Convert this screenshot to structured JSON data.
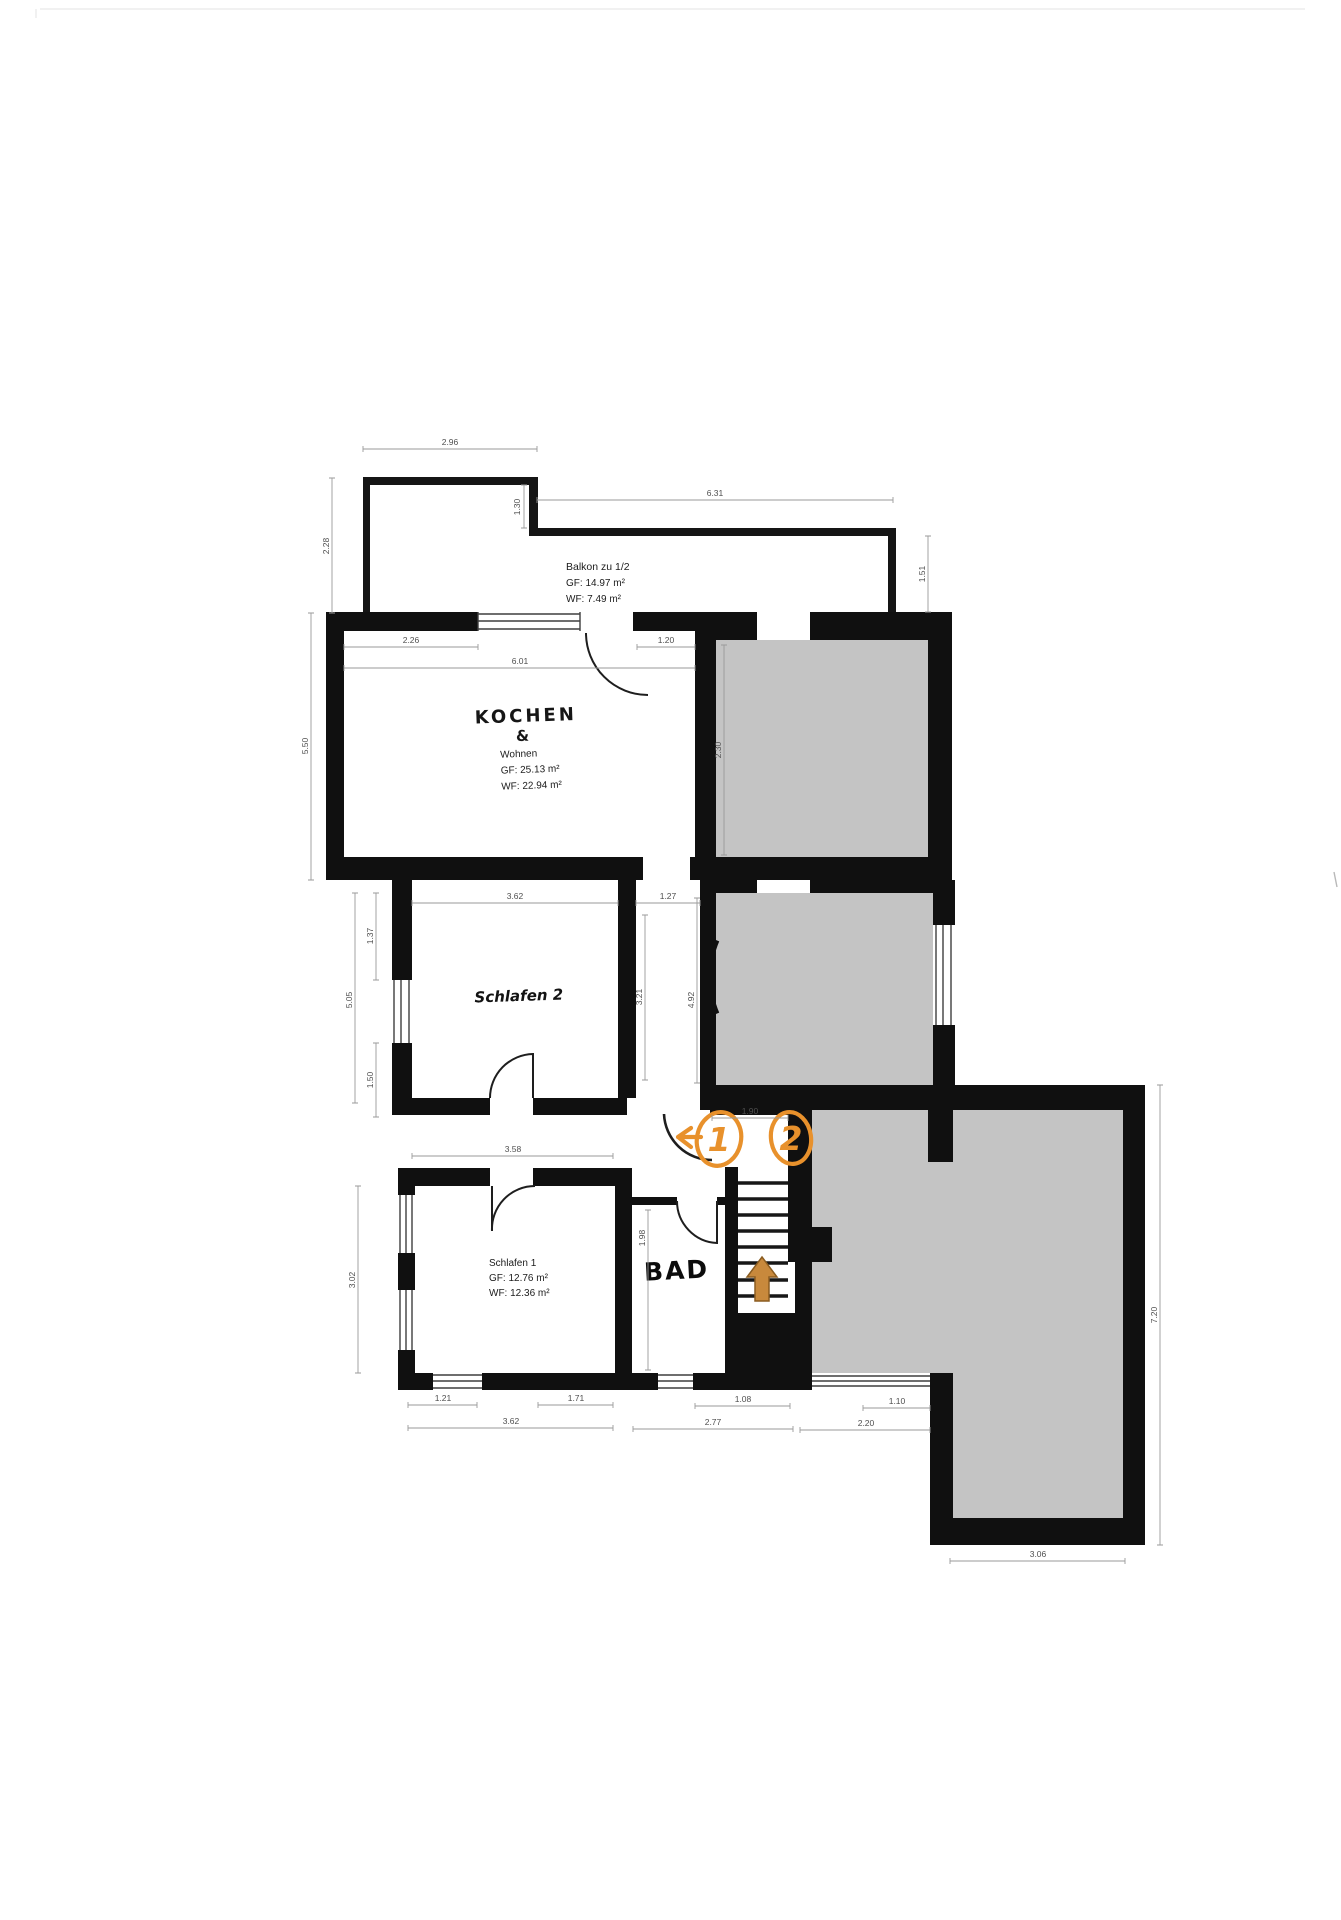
{
  "plan_title": "Obergeschoss Wohnungsplan",
  "colors": {
    "wall": "#101010",
    "neighbor_room_fill": "#c4c4c4",
    "annotation_orange": "#e8912c",
    "stair_arrow_fill": "#c8893c",
    "dim_text": "#4f4f4f"
  },
  "rooms": {
    "balkon": {
      "name": "Balkon zu 1/2",
      "gf": "GF: 14.97 m²",
      "wf": "WF: 7.49 m²"
    },
    "kochen_wohnen": {
      "line1": "KOCHEN",
      "line2": "&",
      "line3": "Wohnen",
      "gf": "GF: 25.13 m²",
      "wf": "WF: 22.94 m²"
    },
    "schlafen2": {
      "name": "Schlafen 2"
    },
    "schlafen1": {
      "name": "Schlafen 1",
      "gf": "GF: 12.76 m²",
      "wf": "WF: 12.36 m²"
    },
    "bad": {
      "name": "BAD"
    }
  },
  "annotations": {
    "route_marker_1": "1",
    "route_marker_2": "2"
  },
  "dims": {
    "balcony_top": "2.96",
    "balcony_span": "6.31",
    "balcony_left": "2.28",
    "balcony_step": "1.30",
    "balcony_right_h": "1.51",
    "kitchen_top": "2.26",
    "kitchen_full": "6.01",
    "kitchen_door": "1.20",
    "kitchen_left": "5.50",
    "gray1_left": "2.30",
    "schlafen2_top": "3.62",
    "corridor_top": "1.27",
    "corridor_len": "3.21",
    "corridor_len2": "4.92",
    "left_upper": "1.37",
    "left_full": "5.05",
    "left_lower": "1.50",
    "flur": "3.58",
    "stairs_door": "1.90",
    "bad_h": "1.98",
    "schlafen1_left": "3.02",
    "bottom_w1": "1.21",
    "bottom_w2": "1.71",
    "bottom_w3": "1.08",
    "bottom_s1": "3.62",
    "bottom_s2": "2.77",
    "terrace_a": "1.10",
    "terrace_b": "2.20",
    "terrace_bottom": "3.06",
    "terrace_right": "7.20"
  }
}
